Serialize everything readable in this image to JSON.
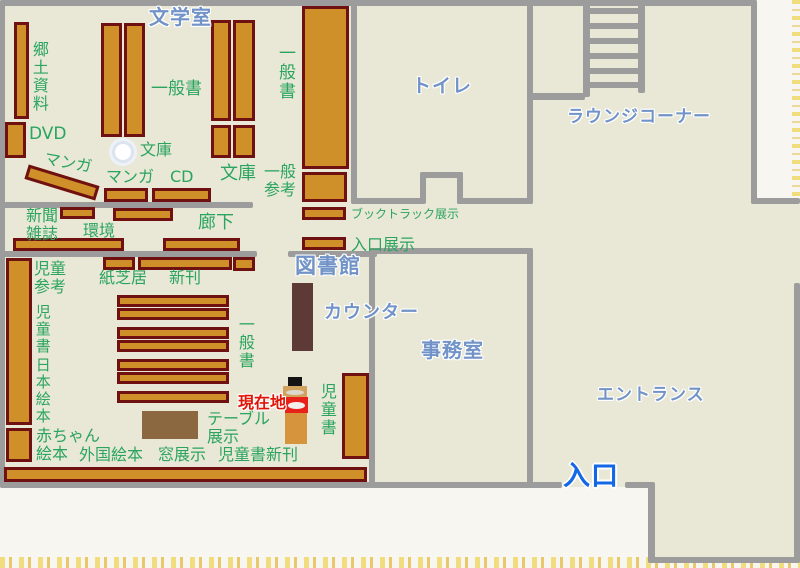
{
  "map": {
    "title": "図書館",
    "colors": {
      "paper": "#f7f6f1",
      "edge_yellow": "#f1dd7d",
      "floor": "#e9e8d7",
      "wall": "#9c9c9c",
      "shelf_fill": "#cf9029",
      "shelf_border": "#6f1011",
      "counter": "#5e3a36",
      "table": "#8b6840",
      "label_green": "#2aa45e",
      "label_blue": "#7193c7",
      "label_blue_strong": "#1467e5",
      "label_red": "#de1507",
      "marker_red": "#e8211a",
      "marker_orange": "#d6943c",
      "marker_tan": "#d2a35e"
    },
    "floors": [
      {
        "name": "floor-main",
        "x": 0,
        "y": 0,
        "w": 757,
        "h": 487
      },
      {
        "name": "floor-entrance-right",
        "x": 757,
        "y": 204,
        "w": 43,
        "h": 353
      },
      {
        "name": "floor-entrance-bottom",
        "x": 650,
        "y": 483,
        "w": 107,
        "h": 74
      }
    ],
    "walls": [
      {
        "name": "wall-top",
        "x": 0,
        "y": 0,
        "w": 757,
        "h": 6
      },
      {
        "name": "wall-left",
        "x": 0,
        "y": 0,
        "w": 5,
        "h": 488
      },
      {
        "name": "wall-right-upper",
        "x": 751,
        "y": 0,
        "w": 6,
        "h": 204
      },
      {
        "name": "wall-step",
        "x": 751,
        "y": 198,
        "w": 49,
        "h": 6
      },
      {
        "name": "wall-right-lower",
        "x": 794,
        "y": 283,
        "w": 6,
        "h": 280
      },
      {
        "name": "wall-bottom-entrance",
        "x": 650,
        "y": 557,
        "w": 150,
        "h": 6
      },
      {
        "name": "wall-entrance-left",
        "x": 648,
        "y": 483,
        "w": 7,
        "h": 80
      },
      {
        "name": "wall-bottom-main",
        "x": 0,
        "y": 482,
        "w": 562,
        "h": 6
      },
      {
        "name": "wall-bottom-door-segment",
        "x": 625,
        "y": 482,
        "w": 30,
        "h": 6
      },
      {
        "name": "wall-toilet-left",
        "x": 351,
        "y": 0,
        "w": 6,
        "h": 204
      },
      {
        "name": "wall-toilet-bottom-left",
        "x": 351,
        "y": 198,
        "w": 72,
        "h": 6
      },
      {
        "name": "wall-toilet-bottom-right",
        "x": 457,
        "y": 198,
        "w": 76,
        "h": 6
      },
      {
        "name": "wall-toilet-door-left",
        "x": 420,
        "y": 172,
        "w": 6,
        "h": 32
      },
      {
        "name": "wall-toilet-door-top",
        "x": 420,
        "y": 172,
        "w": 43,
        "h": 6
      },
      {
        "name": "wall-toilet-door-right",
        "x": 457,
        "y": 172,
        "w": 6,
        "h": 32
      },
      {
        "name": "wall-toilet-right",
        "x": 527,
        "y": 0,
        "w": 6,
        "h": 204
      },
      {
        "name": "wall-lounge-divider",
        "x": 527,
        "y": 93,
        "w": 58,
        "h": 7
      },
      {
        "name": "wall-corridor-top",
        "x": 0,
        "y": 202,
        "w": 253,
        "h": 6
      },
      {
        "name": "wall-corridor-bottom",
        "x": 0,
        "y": 251,
        "w": 257,
        "h": 6
      },
      {
        "name": "wall-counter",
        "x": 288,
        "y": 251,
        "w": 89,
        "h": 6
      },
      {
        "name": "wall-office-top",
        "x": 369,
        "y": 248,
        "w": 164,
        "h": 6
      },
      {
        "name": "wall-office-left",
        "x": 369,
        "y": 248,
        "w": 6,
        "h": 235
      },
      {
        "name": "wall-office-right",
        "x": 527,
        "y": 248,
        "w": 6,
        "h": 235
      }
    ],
    "stairs": {
      "x": 583,
      "w": 62,
      "rails": [
        {
          "name": "stair-rail-left",
          "x": 583,
          "y": 0,
          "w": 7,
          "h": 97
        },
        {
          "name": "stair-rail-right",
          "x": 638,
          "y": 0,
          "w": 7,
          "h": 93
        }
      ],
      "rung_ys": [
        8,
        23,
        38,
        53,
        68,
        82
      ],
      "rung_h": 6
    },
    "shelves": [
      {
        "name": "shelf-local-history",
        "x": 14,
        "y": 22,
        "w": 15,
        "h": 97
      },
      {
        "name": "shelf-dvd",
        "x": 5,
        "y": 122,
        "w": 21,
        "h": 36
      },
      {
        "name": "shelf-literature-a",
        "x": 101,
        "y": 23,
        "w": 21,
        "h": 114
      },
      {
        "name": "shelf-literature-b",
        "x": 124,
        "y": 23,
        "w": 21,
        "h": 114
      },
      {
        "name": "shelf-general-a",
        "x": 211,
        "y": 20,
        "w": 20,
        "h": 101
      },
      {
        "name": "shelf-general-b",
        "x": 233,
        "y": 20,
        "w": 22,
        "h": 101
      },
      {
        "name": "shelf-bunko-a",
        "x": 211,
        "y": 125,
        "w": 20,
        "h": 33
      },
      {
        "name": "shelf-bunko-b",
        "x": 233,
        "y": 125,
        "w": 22,
        "h": 33
      },
      {
        "name": "shelf-general-reference-upper",
        "x": 302,
        "y": 6,
        "w": 47,
        "h": 163
      },
      {
        "name": "shelf-general-reference-lower",
        "x": 302,
        "y": 172,
        "w": 45,
        "h": 30
      },
      {
        "name": "shelf-manga-diagonal",
        "x": 25,
        "y": 175,
        "w": 74,
        "h": 15,
        "rot": 17
      },
      {
        "name": "shelf-manga",
        "x": 104,
        "y": 188,
        "w": 44,
        "h": 14
      },
      {
        "name": "shelf-cd",
        "x": 152,
        "y": 188,
        "w": 59,
        "h": 14
      },
      {
        "name": "shelf-newspaper",
        "x": 60,
        "y": 207,
        "w": 35,
        "h": 12
      },
      {
        "name": "shelf-corridor-1",
        "x": 113,
        "y": 208,
        "w": 60,
        "h": 13
      },
      {
        "name": "shelf-environment",
        "x": 13,
        "y": 238,
        "w": 111,
        "h": 13
      },
      {
        "name": "shelf-corridor-2",
        "x": 163,
        "y": 238,
        "w": 77,
        "h": 13
      },
      {
        "name": "shelf-kamishibai",
        "x": 103,
        "y": 257,
        "w": 32,
        "h": 13
      },
      {
        "name": "shelf-new-arrivals",
        "x": 138,
        "y": 257,
        "w": 94,
        "h": 13
      },
      {
        "name": "shelf-small-right",
        "x": 233,
        "y": 257,
        "w": 22,
        "h": 14
      },
      {
        "name": "shelf-children-left",
        "x": 6,
        "y": 258,
        "w": 26,
        "h": 167
      },
      {
        "name": "shelf-baby-books",
        "x": 6,
        "y": 428,
        "w": 26,
        "h": 34
      },
      {
        "name": "shelf-children-row-1",
        "x": 117,
        "y": 295,
        "w": 112,
        "h": 12
      },
      {
        "name": "shelf-children-row-2",
        "x": 117,
        "y": 308,
        "w": 112,
        "h": 12
      },
      {
        "name": "shelf-children-row-3",
        "x": 117,
        "y": 327,
        "w": 112,
        "h": 12
      },
      {
        "name": "shelf-children-row-4",
        "x": 117,
        "y": 340,
        "w": 112,
        "h": 12
      },
      {
        "name": "shelf-children-row-5",
        "x": 117,
        "y": 359,
        "w": 112,
        "h": 12
      },
      {
        "name": "shelf-children-row-6",
        "x": 117,
        "y": 372,
        "w": 112,
        "h": 12
      },
      {
        "name": "shelf-children-row-7",
        "x": 117,
        "y": 391,
        "w": 112,
        "h": 12
      },
      {
        "name": "shelf-children-right",
        "x": 342,
        "y": 373,
        "w": 27,
        "h": 86
      },
      {
        "name": "shelf-booktruck-display",
        "x": 302,
        "y": 207,
        "w": 44,
        "h": 13
      },
      {
        "name": "shelf-entrance-display",
        "x": 302,
        "y": 237,
        "w": 44,
        "h": 13
      },
      {
        "name": "shelf-window-display",
        "x": 4,
        "y": 467,
        "w": 363,
        "h": 15
      }
    ],
    "furniture": [
      {
        "name": "counter-desk",
        "cls": "counter",
        "x": 292,
        "y": 283,
        "w": 21,
        "h": 68
      },
      {
        "name": "display-table",
        "cls": "table",
        "x": 142,
        "y": 411,
        "w": 56,
        "h": 28
      },
      {
        "name": "pillar",
        "cls": "pillar",
        "x": 112,
        "y": 141,
        "w": 22,
        "h": 22
      },
      {
        "name": "marker-hat",
        "cls": "marker-black",
        "x": 288,
        "y": 377,
        "w": 14,
        "h": 9
      },
      {
        "name": "marker-upper-box",
        "cls": "marker-tan",
        "x": 283,
        "y": 386,
        "w": 24,
        "h": 12,
        "arc": "#ddd8cc"
      },
      {
        "name": "marker-here-box",
        "cls": "marker-red",
        "x": 285,
        "y": 397,
        "w": 23,
        "h": 16,
        "arc": "#f2f0ea"
      },
      {
        "name": "marker-base",
        "cls": "marker-orange",
        "x": 285,
        "y": 413,
        "w": 22,
        "h": 31
      }
    ],
    "labels": [
      {
        "name": "label-literature-room",
        "text": "文学室",
        "x": 149,
        "y": 6,
        "size": 20,
        "color": "blue"
      },
      {
        "name": "label-toilet",
        "text": "トイレ",
        "x": 412,
        "y": 76,
        "size": 19,
        "color": "blue"
      },
      {
        "name": "label-lounge-corner",
        "text": "ラウンジコーナー",
        "x": 567,
        "y": 108,
        "size": 17,
        "color": "blue"
      },
      {
        "name": "label-library",
        "text": "図書館",
        "x": 295,
        "y": 255,
        "size": 21,
        "color": "blue"
      },
      {
        "name": "label-counter",
        "text": "カウンター",
        "x": 324,
        "y": 303,
        "size": 18,
        "color": "blue"
      },
      {
        "name": "label-office",
        "text": "事務室",
        "x": 421,
        "y": 339,
        "size": 20,
        "color": "blue"
      },
      {
        "name": "label-entrance-hall",
        "text": "エントランス",
        "x": 597,
        "y": 386,
        "size": 17,
        "color": "blue"
      },
      {
        "name": "label-entrance",
        "text": "入口",
        "x": 563,
        "y": 462,
        "size": 27,
        "color": "blue-strong"
      },
      {
        "name": "label-current-location",
        "text": "現在地",
        "x": 238,
        "y": 394,
        "size": 16,
        "color": "red"
      },
      {
        "name": "label-local-history",
        "text": "郷土資料",
        "x": 30,
        "y": 41,
        "size": 16,
        "color": "green",
        "mode": "v"
      },
      {
        "name": "label-dvd",
        "text": "DVD",
        "x": 29,
        "y": 125,
        "size": 17,
        "color": "green"
      },
      {
        "name": "label-manga-diagonal",
        "text": "マンガ",
        "x": 46,
        "y": 150,
        "size": 16,
        "color": "green",
        "rot": 10
      },
      {
        "name": "label-general-books-1",
        "text": "一般書",
        "x": 151,
        "y": 80,
        "size": 17,
        "color": "green"
      },
      {
        "name": "label-bunko-1",
        "text": "文庫",
        "x": 140,
        "y": 141,
        "size": 16,
        "color": "green"
      },
      {
        "name": "label-manga",
        "text": "マンガ",
        "x": 106,
        "y": 168,
        "size": 16,
        "color": "green"
      },
      {
        "name": "label-cd",
        "text": "CD",
        "x": 170,
        "y": 168,
        "size": 16,
        "color": "green"
      },
      {
        "name": "label-bunko-2",
        "text": "文庫",
        "x": 220,
        "y": 164,
        "size": 18,
        "color": "green"
      },
      {
        "name": "label-general-books-2",
        "text": "一般書",
        "x": 275,
        "y": 44,
        "size": 17,
        "color": "green",
        "mode": "v"
      },
      {
        "name": "label-general-reference",
        "text": "一般\n参考",
        "x": 264,
        "y": 163,
        "size": 16,
        "color": "green"
      },
      {
        "name": "label-newspaper-magazines",
        "text": "新聞\n雑誌",
        "x": 26,
        "y": 207,
        "size": 16,
        "color": "green"
      },
      {
        "name": "label-environment",
        "text": "環境",
        "x": 83,
        "y": 222,
        "size": 16,
        "color": "green"
      },
      {
        "name": "label-corridor",
        "text": "廊下",
        "x": 198,
        "y": 213,
        "size": 18,
        "color": "green"
      },
      {
        "name": "label-booktruck-display",
        "text": "ブックトラック展示",
        "x": 351,
        "y": 208,
        "size": 12,
        "color": "green"
      },
      {
        "name": "label-entrance-display",
        "text": "入口展示",
        "x": 351,
        "y": 236,
        "size": 16,
        "color": "green"
      },
      {
        "name": "label-children-reference",
        "text": "児童\n参考",
        "x": 34,
        "y": 260,
        "size": 16,
        "color": "green"
      },
      {
        "name": "label-children-books-left",
        "text": "児童書",
        "x": 34,
        "y": 304,
        "size": 15,
        "color": "green",
        "mode": "v"
      },
      {
        "name": "label-japanese-picture-books",
        "text": "日本絵本",
        "x": 34,
        "y": 357,
        "size": 15,
        "color": "green",
        "mode": "v"
      },
      {
        "name": "label-kamishibai",
        "text": "紙芝居",
        "x": 99,
        "y": 269,
        "size": 16,
        "color": "green"
      },
      {
        "name": "label-new-arrivals",
        "text": "新刊",
        "x": 169,
        "y": 269,
        "size": 16,
        "color": "green"
      },
      {
        "name": "label-general-books-3",
        "text": "一般書",
        "x": 236,
        "y": 316,
        "size": 16,
        "color": "green",
        "mode": "v"
      },
      {
        "name": "label-baby-picture-books",
        "text": "赤ちゃん\n絵本",
        "x": 36,
        "y": 427,
        "size": 16,
        "color": "green"
      },
      {
        "name": "label-foreign-picture-books",
        "text": "外国絵本",
        "x": 79,
        "y": 446,
        "size": 16,
        "color": "green"
      },
      {
        "name": "label-window-display",
        "text": "窓展示",
        "x": 158,
        "y": 446,
        "size": 16,
        "color": "green"
      },
      {
        "name": "label-children-new-arrivals",
        "text": "児童書新刊",
        "x": 218,
        "y": 446,
        "size": 16,
        "color": "green"
      },
      {
        "name": "label-table-display",
        "text": "テーブル\n展示",
        "x": 207,
        "y": 410,
        "size": 16,
        "color": "green"
      },
      {
        "name": "label-children-books-right",
        "text": "児童書",
        "x": 318,
        "y": 383,
        "size": 16,
        "color": "green",
        "mode": "v"
      }
    ]
  }
}
